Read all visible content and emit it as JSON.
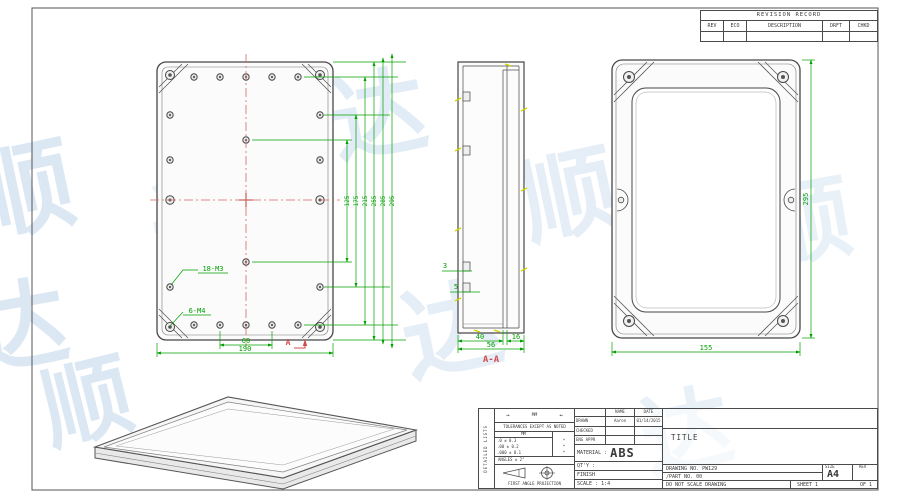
{
  "watermark": {
    "glyph_a": "顺",
    "glyph_b": "达"
  },
  "revision_table": {
    "title": "REVISION RECORD",
    "col_rev": "REV",
    "col_eco": "ECO",
    "col_description": "DESCRIPTION",
    "col_drft": "DRFT",
    "col_chkd": "CHKD"
  },
  "front_view": {
    "label_small_holes": "18-M3",
    "label_large_holes": "6-M4",
    "dim_hole_span": "60",
    "dim_overall_width": "190",
    "section_arrow": "A",
    "stacked_dims": [
      "125",
      "175",
      "215",
      "255",
      "285",
      "295"
    ]
  },
  "section_view": {
    "label": "A-A",
    "dim_inner_depth": "40",
    "dim_lid": "16",
    "dim_total": "56",
    "dim_rib_top": "3",
    "dim_rib_bottom": "5"
  },
  "top_view": {
    "dim_width": "155",
    "dim_height": "295"
  },
  "title_block": {
    "side_label": "DETAILED LISTS",
    "units": "MM",
    "tol_note": "TOLERANCES EXCEPT AS NOTED",
    "tol_unit_header": "MM",
    "tol_rows": [
      {
        "value": ".0 ± 0.3",
        "mark": "*"
      },
      {
        "value": ".00 ± 0.2",
        "mark": "*"
      },
      {
        "value": ".000 ± 0.1",
        "mark": "*"
      }
    ],
    "angles": "ANGLES ± 2°",
    "projection": "FIRST ANGLE PROJECTION",
    "name_header": "NAME",
    "date_header": "DATE",
    "drawn_label": "DRAWN",
    "drawn_name": "Aaron",
    "drawn_date": "01/14/2015",
    "checked_label": "CHECKED",
    "eng_appr_label": "ENG APPR",
    "material_label": "MATERIAL :",
    "material_value": "ABS",
    "qty_label": "QT'Y :",
    "finish_label": "FINISH",
    "scale_label": "SCALE : 1:4",
    "title_label": "TITLE",
    "drawing_no": "DRAWING NO. PW129",
    "part_no": "/PART  NO.    00",
    "size_label": "SIZE",
    "size_value": "A4",
    "rev_label": "REV",
    "do_not_scale": "DO NOT SCALE DRAWING",
    "sheet": "SHEET 1",
    "of": "OF 1"
  }
}
